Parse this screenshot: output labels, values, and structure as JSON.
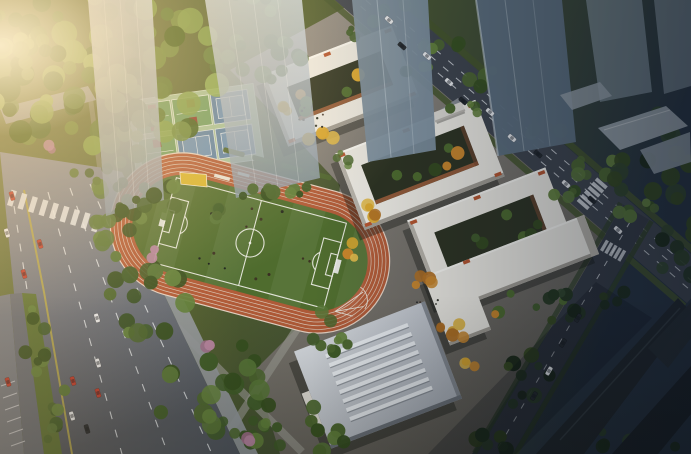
{
  "meta": {
    "type": "architectural-aerial-rendering",
    "description": "Dusk aerial rendering of a school campus: oval running track with soccer field, basketball and tennis courts, white courtyard teaching buildings with autumn trees, a skylit gymnasium, tree-lined avenues with traffic, translucent glass towers and dark high-rise silhouettes"
  },
  "palette": {
    "road_west_light": "#8e95a0",
    "road_west_dark": "#50565f",
    "road_north": "#3e444d",
    "road_east": "#343a43",
    "lane_yellow": "#b3a64d",
    "lane_white": "#e9edf1",
    "median_green": "#5a7134",
    "sidewalk": "#91979b",
    "paving_light": "#97928b",
    "paving_dark": "#5f5c55",
    "track_orange": "#b15b38",
    "track_line": "#d9c4b3",
    "field_green": "#4f6c2e",
    "field_line": "#e9eae2",
    "sand_yellow": "#d8b52f",
    "court_base": "#a6c29b",
    "court_green": "#6f9e63",
    "court_red": "#8d382a",
    "court_blue": "#5e83a6",
    "court_blue_in": "#6d92b5",
    "bldg_white": "#eceae3",
    "bldg_shade": "#b7b3aa",
    "bldg_wall": "#a19d94",
    "bldg_accent": "#b5552f",
    "courtyard_dark": "#2d3322",
    "courtyard_wall": "#a4623c",
    "gym_skylight": "#edf1f5",
    "gym_wall": "#868c94",
    "gym_wall2": "#6e747c",
    "tower_mid": "#7b8e9d",
    "tower_dark": "#5d7080",
    "lowrise": "#9aa4ac",
    "silhouette": "#20262b",
    "shadow": "rgba(15,18,12,0.38)",
    "verge_green": "#44552b",
    "path_gray": "#97978f"
  },
  "scene": {
    "sports": {
      "track": {
        "lanes": 6,
        "cx": 250,
        "cy": 243,
        "rot": 15
      },
      "courts": {
        "rows": 2,
        "cols": 3,
        "cx": 195,
        "cy": 130,
        "rot": -8,
        "types": [
          "basketball",
          "basketball",
          "tennis",
          "basketball",
          "tennis",
          "tennis"
        ]
      }
    },
    "buildings": [
      {
        "id": "teaching-building-a",
        "type": "courtyard",
        "cx": 340,
        "cy": 86,
        "w": 140,
        "h": 76,
        "rot": -21,
        "ring": 20
      },
      {
        "id": "teaching-building-b",
        "type": "courtyard",
        "cx": 420,
        "cy": 165,
        "w": 150,
        "h": 82,
        "rot": -21,
        "ring": 20
      },
      {
        "id": "teaching-building-c",
        "type": "courtyard",
        "cx": 492,
        "cy": 235,
        "w": 148,
        "h": 88,
        "rot": -21,
        "ring": 21
      },
      {
        "id": "south-l-building",
        "type": "lshape",
        "cx": 505,
        "cy": 288,
        "rot": -21,
        "wings": [
          {
            "x": -30,
            "y": -40,
            "w": 130,
            "h": 42
          },
          {
            "x": -72,
            "y": -40,
            "w": 44,
            "h": 74
          }
        ],
        "court": {
          "x": -20,
          "y": 6,
          "w": 74,
          "h": 30
        }
      },
      {
        "id": "gymnasium",
        "type": "gym",
        "cx": 378,
        "cy": 375,
        "w": 140,
        "h": 104,
        "rot": -21,
        "stripes": 8
      },
      {
        "id": "entrance-gate",
        "type": "gate",
        "cx": 449,
        "cy": 113,
        "rot": -21
      }
    ],
    "vegetation": {
      "palettes": {
        "warmgreen": [
          "#6d8b3f",
          "#5a7a35",
          "#4c6a2e",
          "#7fa04a",
          "#8fae56",
          "#42601f"
        ],
        "green": [
          "#4c672f",
          "#3f5c28",
          "#587638",
          "#365020",
          "#62813c"
        ],
        "dark": [
          "#2b4025",
          "#22351e",
          "#35491f",
          "#1c2b18",
          "#31452b"
        ],
        "yellow": [
          "#d9a62e",
          "#c8862c",
          "#e0b84a",
          "#b06f22"
        ],
        "pink": [
          "#b685a0",
          "#a06f8a"
        ],
        "people": [
          "#24281e",
          "#3a2d22",
          "#14181a"
        ]
      },
      "clusters": [
        {
          "x": 105,
          "y": 80,
          "rx": 120,
          "ry": 85,
          "n": 80,
          "s": [
            6,
            13
          ],
          "p": "warmgreen"
        },
        {
          "x": 28,
          "y": 35,
          "rx": 45,
          "ry": 40,
          "n": 20,
          "s": [
            5,
            10
          ],
          "p": "warmgreen"
        },
        {
          "x": 255,
          "y": 60,
          "rx": 50,
          "ry": 26,
          "n": 16,
          "s": [
            5,
            9
          ],
          "p": "green"
        },
        {
          "x": 118,
          "y": 222,
          "rx": 26,
          "ry": 36,
          "n": 12,
          "s": [
            5,
            9
          ],
          "p": "green"
        },
        {
          "x": 148,
          "y": 298,
          "rx": 42,
          "ry": 42,
          "n": 16,
          "s": [
            5,
            10
          ],
          "p": "green"
        },
        {
          "x": 210,
          "y": 385,
          "rx": 68,
          "ry": 52,
          "n": 22,
          "s": [
            5,
            11
          ],
          "p": "green"
        },
        {
          "x": 300,
          "y": 428,
          "rx": 52,
          "ry": 26,
          "n": 13,
          "s": [
            5,
            9
          ],
          "p": "green"
        },
        {
          "x": 330,
          "y": 330,
          "rx": 26,
          "ry": 22,
          "n": 9,
          "s": [
            4,
            8
          ],
          "p": "green"
        },
        {
          "x": 36,
          "y": 338,
          "rx": 13,
          "ry": 38,
          "n": 9,
          "s": [
            4,
            7
          ],
          "p": "green"
        },
        {
          "x": 56,
          "y": 412,
          "rx": 15,
          "ry": 36,
          "n": 8,
          "s": [
            4,
            7
          ],
          "p": "green"
        },
        {
          "x": 98,
          "y": 180,
          "rx": 28,
          "ry": 14,
          "n": 8,
          "s": [
            4,
            8
          ],
          "p": "green"
        },
        {
          "x": 120,
          "y": 128,
          "rx": 20,
          "ry": 12,
          "n": 5,
          "s": [
            4,
            7
          ],
          "p": "green"
        },
        {
          "x": 394,
          "y": -2,
          "rx": 26,
          "ry": 13,
          "n": 6,
          "s": [
            4,
            8
          ],
          "p": "green"
        },
        {
          "x": 444,
          "y": 40,
          "rx": 26,
          "ry": 13,
          "n": 6,
          "s": [
            4,
            8
          ],
          "p": "green"
        },
        {
          "x": 494,
          "y": 83,
          "rx": 26,
          "ry": 13,
          "n": 6,
          "s": [
            4,
            8
          ],
          "p": "green"
        },
        {
          "x": 544,
          "y": 126,
          "rx": 26,
          "ry": 13,
          "n": 6,
          "s": [
            4,
            8
          ],
          "p": "green"
        },
        {
          "x": 594,
          "y": 169,
          "rx": 26,
          "ry": 13,
          "n": 6,
          "s": [
            4,
            8
          ],
          "p": "green"
        },
        {
          "x": 644,
          "y": 212,
          "rx": 26,
          "ry": 13,
          "n": 6,
          "s": [
            4,
            8
          ],
          "p": "green"
        },
        {
          "x": 366,
          "y": 30,
          "rx": 18,
          "ry": 10,
          "n": 4,
          "s": [
            3,
            7
          ],
          "p": "green"
        },
        {
          "x": 414,
          "y": 70,
          "rx": 18,
          "ry": 10,
          "n": 4,
          "s": [
            3,
            7
          ],
          "p": "green"
        },
        {
          "x": 462,
          "y": 112,
          "rx": 18,
          "ry": 10,
          "n": 4,
          "s": [
            3,
            7
          ],
          "p": "green"
        },
        {
          "x": 560,
          "y": 196,
          "rx": 18,
          "ry": 10,
          "n": 4,
          "s": [
            3,
            7
          ],
          "p": "green"
        },
        {
          "x": 648,
          "y": 160,
          "rx": 55,
          "ry": 48,
          "n": 15,
          "s": [
            6,
            11
          ],
          "p": "dark"
        },
        {
          "x": 678,
          "y": 248,
          "rx": 26,
          "ry": 40,
          "n": 10,
          "s": [
            5,
            9
          ],
          "p": "dark"
        },
        {
          "x": 556,
          "y": 310,
          "rx": 24,
          "ry": 20,
          "n": 8,
          "s": [
            4,
            8
          ],
          "p": "dark"
        },
        {
          "x": 528,
          "y": 382,
          "rx": 26,
          "ry": 30,
          "n": 9,
          "s": [
            4,
            8
          ],
          "p": "dark"
        },
        {
          "x": 500,
          "y": 438,
          "rx": 24,
          "ry": 14,
          "n": 6,
          "s": [
            4,
            8
          ],
          "p": "dark"
        },
        {
          "x": 610,
          "y": 296,
          "rx": 16,
          "ry": 12,
          "n": 4,
          "s": [
            4,
            7
          ],
          "p": "dark"
        },
        {
          "x": 636,
          "y": 438,
          "rx": 52,
          "ry": 18,
          "n": 8,
          "s": [
            4,
            9
          ],
          "p": "dark"
        },
        {
          "x": 318,
          "y": 136,
          "rx": 16,
          "ry": 9,
          "n": 4,
          "s": [
            4,
            7
          ],
          "p": "yellow"
        },
        {
          "x": 296,
          "y": 108,
          "rx": 13,
          "ry": 8,
          "n": 3,
          "s": [
            4,
            6
          ],
          "p": "yellow"
        },
        {
          "x": 372,
          "y": 212,
          "rx": 14,
          "ry": 9,
          "n": 4,
          "s": [
            4,
            7
          ],
          "p": "yellow"
        },
        {
          "x": 420,
          "y": 282,
          "rx": 16,
          "ry": 8,
          "n": 4,
          "s": [
            4,
            7
          ],
          "p": "yellow"
        },
        {
          "x": 446,
          "y": 330,
          "rx": 30,
          "ry": 9,
          "n": 6,
          "s": [
            4,
            7
          ],
          "p": "yellow"
        },
        {
          "x": 472,
          "y": 360,
          "rx": 10,
          "ry": 10,
          "n": 3,
          "s": [
            4,
            7
          ],
          "p": "yellow"
        },
        {
          "x": 352,
          "y": 250,
          "rx": 12,
          "ry": 8,
          "n": 3,
          "s": [
            4,
            6
          ],
          "p": "yellow"
        },
        {
          "x": 338,
          "y": 160,
          "rx": 18,
          "ry": 8,
          "n": 4,
          "s": [
            3,
            6
          ],
          "p": "green"
        },
        {
          "x": 300,
          "y": 190,
          "rx": 14,
          "ry": 8,
          "n": 4,
          "s": [
            3,
            6
          ],
          "p": "green"
        },
        {
          "x": 250,
          "y": 4,
          "rx": 42,
          "ry": 10,
          "n": 6,
          "s": [
            4,
            8
          ],
          "p": "green"
        },
        {
          "x": 252,
          "y": 432,
          "rx": 20,
          "ry": 14,
          "n": 6,
          "s": [
            4,
            8
          ],
          "p": "green"
        },
        {
          "x": 158,
          "y": 190,
          "rx": 20,
          "ry": 14,
          "n": 6,
          "s": [
            4,
            8
          ],
          "p": "green"
        },
        {
          "x": 205,
          "y": 352,
          "rx": 10,
          "ry": 8,
          "n": 2,
          "s": [
            5,
            7
          ],
          "p": "pink"
        },
        {
          "x": 246,
          "y": 438,
          "rx": 10,
          "ry": 6,
          "n": 2,
          "s": [
            5,
            7
          ],
          "p": "pink"
        },
        {
          "x": 52,
          "y": 148,
          "rx": 8,
          "ry": 6,
          "n": 2,
          "s": [
            4,
            6
          ],
          "p": "pink"
        },
        {
          "x": 150,
          "y": 252,
          "rx": 8,
          "ry": 6,
          "n": 2,
          "s": [
            4,
            6
          ],
          "p": "pink"
        },
        {
          "x": 250,
          "y": 243,
          "rx": 82,
          "ry": 36,
          "n": 16,
          "s": [
            0.9,
            1.6
          ],
          "p": "people"
        },
        {
          "x": 312,
          "y": 118,
          "rx": 30,
          "ry": 11,
          "n": 8,
          "s": [
            0.8,
            1.4
          ],
          "p": "people"
        },
        {
          "x": 422,
          "y": 300,
          "rx": 18,
          "ry": 7,
          "n": 4,
          "s": [
            0.8,
            1.3
          ],
          "p": "people"
        }
      ],
      "front_clusters": [
        {
          "x": 150,
          "y": 205,
          "rx": 32,
          "ry": 14,
          "n": 7,
          "s": [
            4,
            9
          ],
          "p": "green"
        },
        {
          "x": 258,
          "y": 196,
          "rx": 22,
          "ry": 10,
          "n": 5,
          "s": [
            4,
            8
          ],
          "p": "green"
        },
        {
          "x": 205,
          "y": 212,
          "rx": 18,
          "ry": 8,
          "n": 4,
          "s": [
            4,
            7
          ],
          "p": "green"
        }
      ]
    },
    "traffic": {
      "car_colors": {
        "red": "#bf3b2d",
        "white": "#e8ebee",
        "dark": "#23282d"
      },
      "roads": [
        {
          "name": "west-avenue-traffic",
          "rot": 73,
          "cars": [
            [
              12,
              196,
              "red"
            ],
            [
              7,
              233,
              "white"
            ],
            [
              40,
              244,
              "red"
            ],
            [
              24,
              274,
              "red"
            ],
            [
              97,
              318,
              "white"
            ],
            [
              98,
              363,
              "white"
            ],
            [
              73,
              381,
              "red"
            ],
            [
              98,
              393,
              "red"
            ],
            [
              72,
              416,
              "white"
            ],
            [
              87,
              429,
              "dark"
            ],
            [
              8,
              382,
              "red"
            ]
          ]
        },
        {
          "name": "north-road-traffic",
          "rot": 41,
          "cars": [
            [
              389,
              20,
              "white"
            ],
            [
              402,
              46,
              "dark"
            ],
            [
              427,
              56,
              "white"
            ],
            [
              449,
              82,
              "white"
            ],
            [
              463,
              101,
              "dark"
            ],
            [
              490,
              112,
              "white"
            ],
            [
              512,
              138,
              "white"
            ],
            [
              538,
              154,
              "dark"
            ],
            [
              566,
              184,
              "white"
            ],
            [
              592,
              200,
              "dark"
            ],
            [
              618,
              230,
              "white"
            ]
          ]
        },
        {
          "name": "east-road-traffic",
          "rot": 120,
          "cars": [
            [
              578,
              318,
              "dark"
            ],
            [
              563,
              343,
              "dark"
            ],
            [
              549,
              371,
              "white"
            ],
            [
              534,
              396,
              "dark"
            ]
          ]
        }
      ]
    }
  }
}
